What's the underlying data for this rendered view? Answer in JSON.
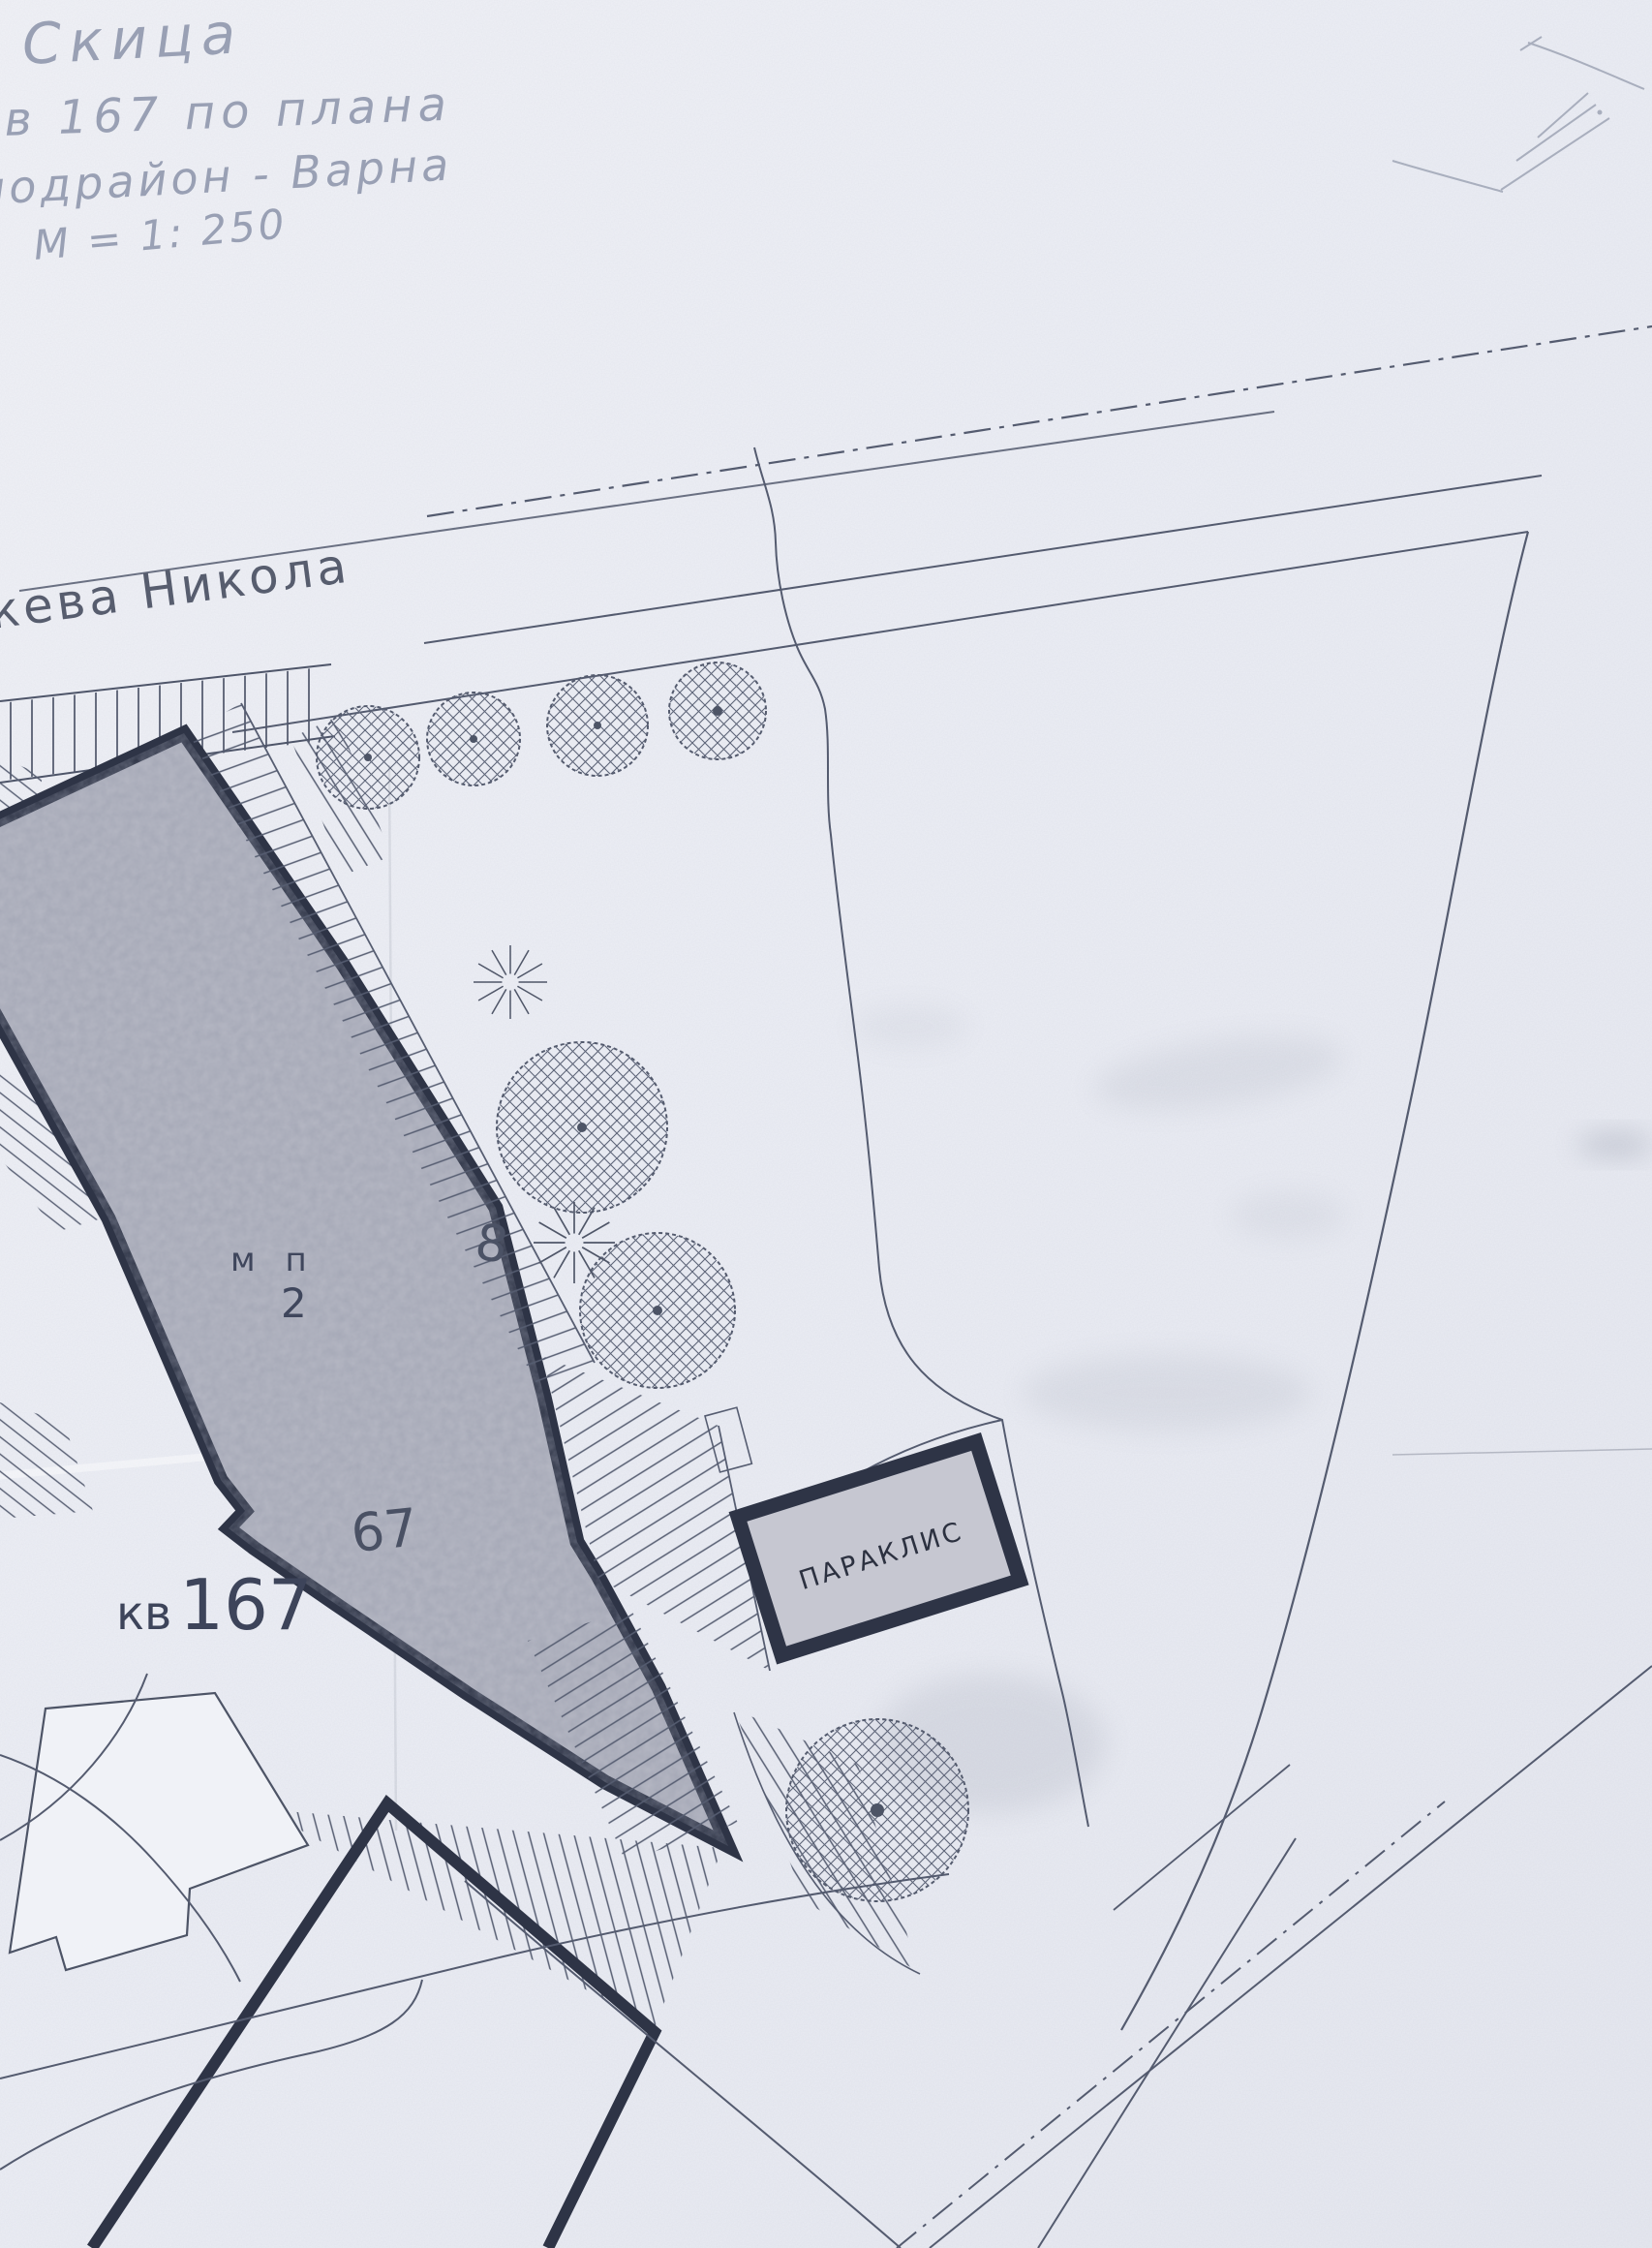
{
  "title_block": {
    "title": "Скица",
    "plan_line": "кв 167 по плана",
    "district_line": "подрайон - Варна",
    "scale": "М = 1: 250"
  },
  "street": {
    "name": "кева Никола"
  },
  "block": {
    "prefix": "кв",
    "number": "167"
  },
  "parcel": {
    "number": "67",
    "use_code": "м п",
    "use_index": "2"
  },
  "chapel": {
    "label": "ПАРАКЛИС"
  },
  "survey_point": {
    "label": "8"
  },
  "colors": {
    "paper": "#edeff5",
    "ink": "#2e3446",
    "thin_line": "#545b6f",
    "pencil": "#959cb0",
    "parcel_fill": "#b5b7c3",
    "chapel_fill": "#c6c7d1"
  }
}
